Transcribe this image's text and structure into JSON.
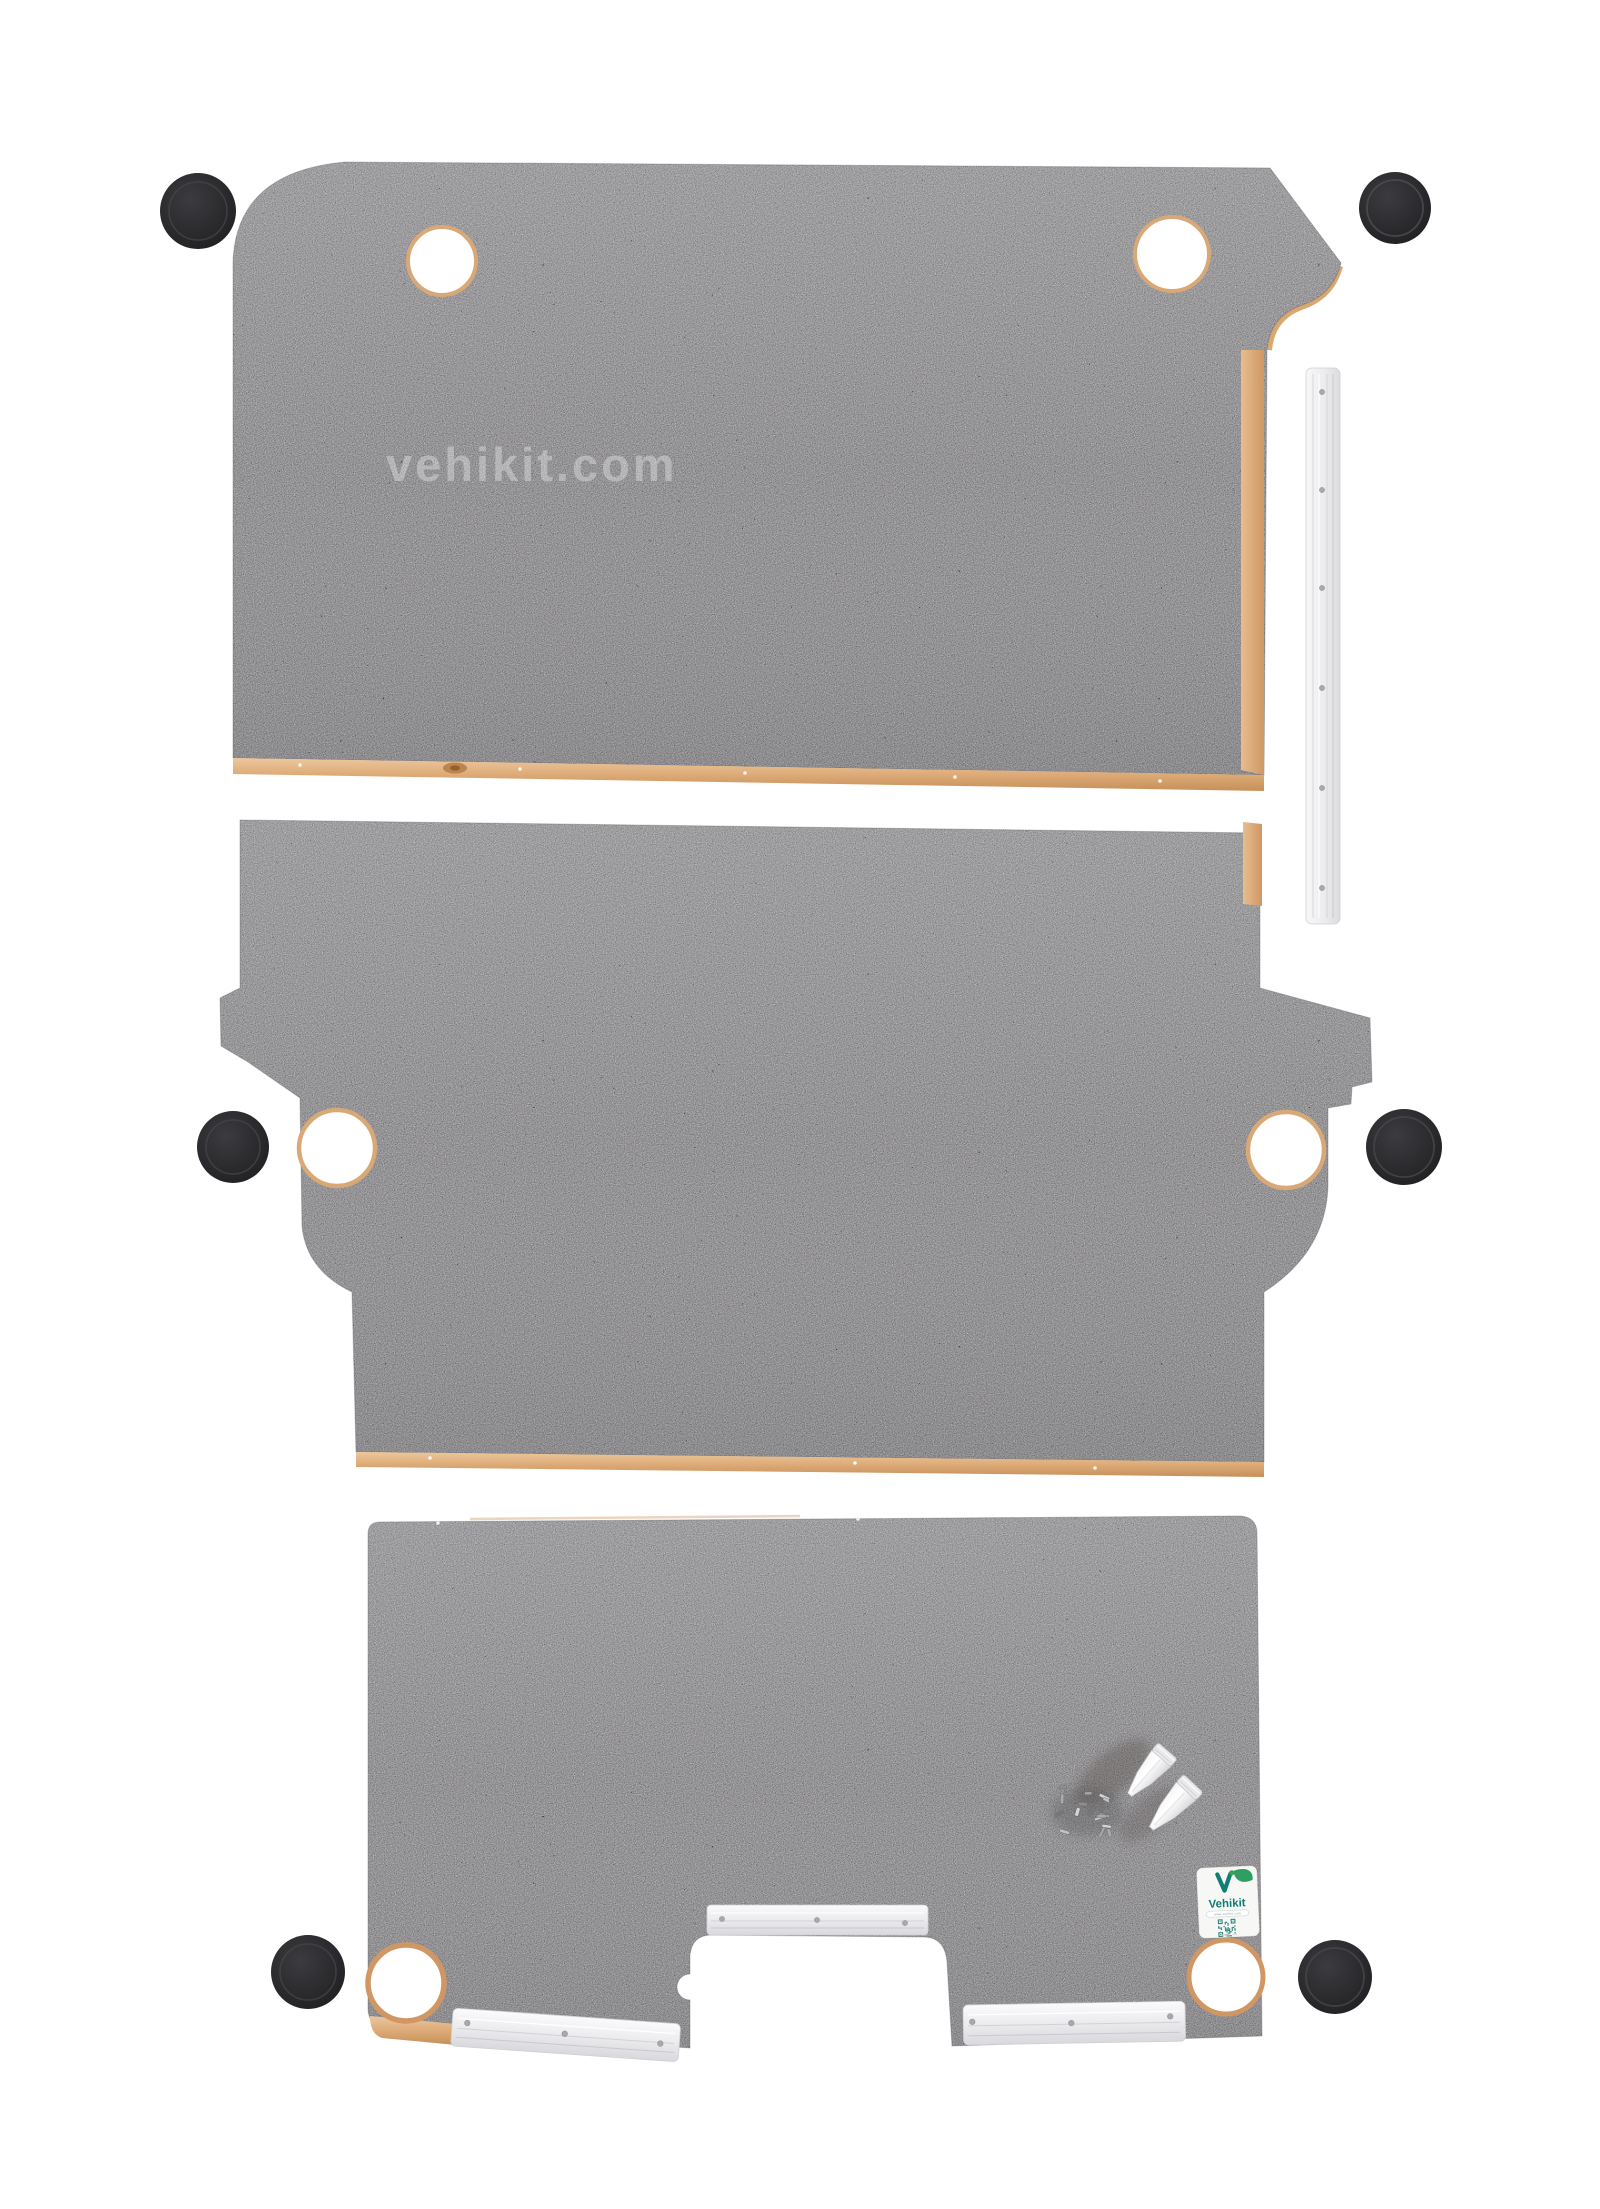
{
  "meta": {
    "type": "product-photo",
    "description": "Three-piece grey speckled plywood van floor lining kit laid flat on a white background with fixing accessories"
  },
  "watermark": {
    "text": "vehikit.com"
  },
  "label": {
    "brand": "Vehikit",
    "website": "www.vehikit.com"
  },
  "parts": {
    "panels": [
      {
        "name": "front floor panel"
      },
      {
        "name": "middle floor panel"
      },
      {
        "name": "rear floor panel"
      }
    ],
    "screw_caps_count": 6,
    "aluminium_strips_count": 4,
    "glue_tubes_count": 2,
    "screws": "pile of fixing screws"
  },
  "colors": {
    "background": "#ffffff",
    "panel_base": "#98969a",
    "plywood_edge": "#dcaa78",
    "screw_cap": "#29292c",
    "aluminium": "#ececee",
    "brand_teal": "#117e74",
    "brand_green": "#3aa34f"
  }
}
